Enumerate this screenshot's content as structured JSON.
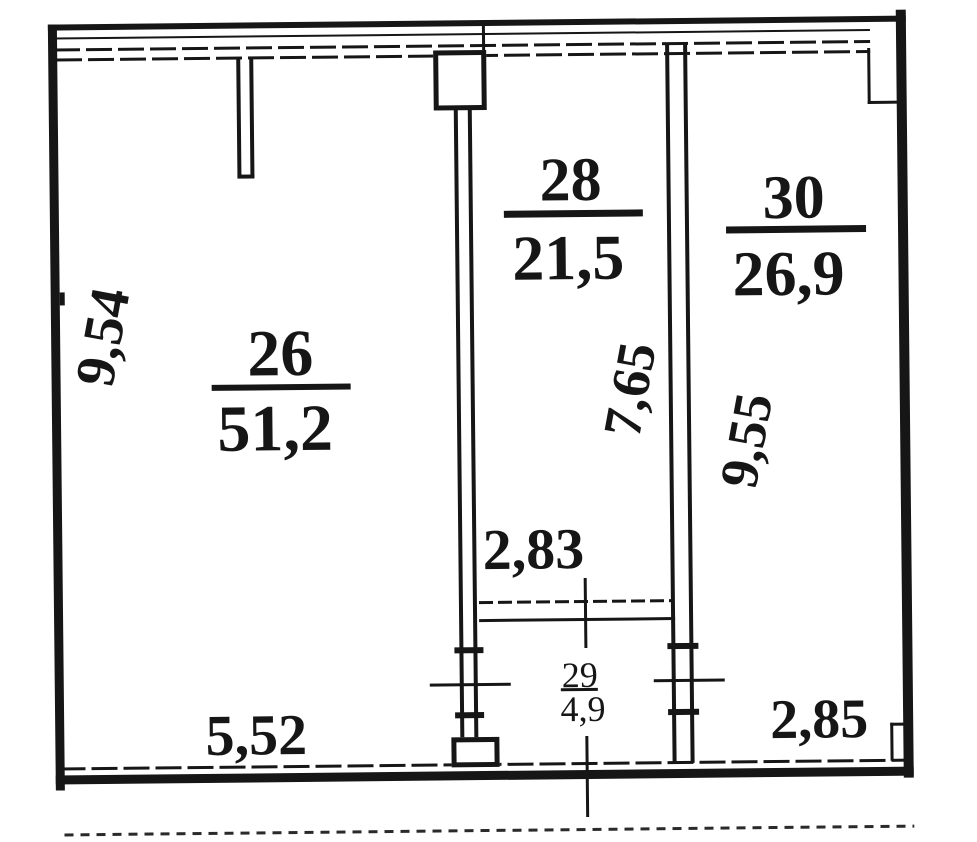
{
  "figure": {
    "type": "floor-plan",
    "style": "scanned technical drawing (BTI plan)",
    "colors": {
      "ink": "#161616",
      "paper": "#ffffff"
    }
  },
  "rooms": [
    {
      "number": "26",
      "area": "51,2"
    },
    {
      "number": "28",
      "area": "21,5"
    },
    {
      "number": "29",
      "area": "4,9"
    },
    {
      "number": "30",
      "area": "26,9"
    }
  ],
  "dimensions": {
    "left_height": "9,54",
    "room28_height": "7,65",
    "room30_height": "9,55",
    "opening_width": "2,83",
    "bottom_left_width": "5,52",
    "bottom_right_width": "2,85"
  }
}
